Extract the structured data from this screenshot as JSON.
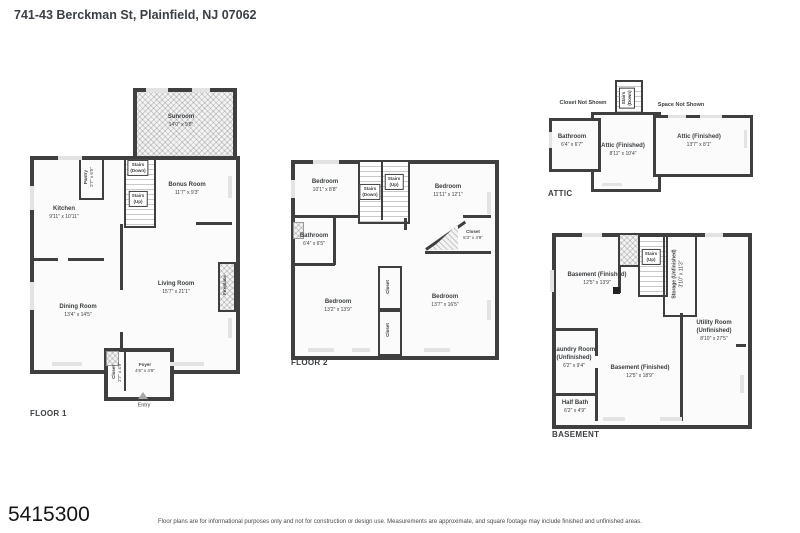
{
  "header": {
    "title": "741-43 Berckman St, Plainfield, NJ 07062"
  },
  "floor1": {
    "label": "FLOOR 1",
    "sunroom": {
      "name": "Sunroom",
      "dims": "14'0\" x 9'8\""
    },
    "pantry": {
      "name": "Pantry",
      "dims": "2'7\" x 6'5\""
    },
    "stairs_down": "Stairs\n(Down)",
    "stairs_up": "Stairs\n(Up)",
    "bonus": {
      "name": "Bonus Room",
      "dims": "11'7\" x 9'3\""
    },
    "kitchen": {
      "name": "Kitchen",
      "dims": "9'11\" x 10'11\""
    },
    "dining": {
      "name": "Dining Room",
      "dims": "13'4\" x 14'5\""
    },
    "living": {
      "name": "Living Room",
      "dims": "15'7\" x 21'1\""
    },
    "fireplace": {
      "name": "Fireplace"
    },
    "closet": {
      "name": "Closet",
      "dims": "2'7\" x 4'9\""
    },
    "foyer": {
      "name": "Foyer",
      "dims": "4'6\" x 4'9\""
    },
    "entry": {
      "name": "Entry"
    }
  },
  "floor2": {
    "label": "FLOOR 2",
    "bed1": {
      "name": "Bedroom",
      "dims": "10'1\" x 8'8\""
    },
    "bed2": {
      "name": "Bedroom",
      "dims": "11'11\" x 12'1\""
    },
    "bed3": {
      "name": "Bedroom",
      "dims": "13'2\" x 13'9\""
    },
    "bed4": {
      "name": "Bedroom",
      "dims": "13'7\" x 16'5\""
    },
    "stairs_down": "Stairs\n(Down)",
    "stairs_up": "Stairs\n(Up)",
    "bathroom": {
      "name": "Bathroom",
      "dims": "6'4\" x 6'5\""
    },
    "closet_right": {
      "name": "Closet",
      "dims": "5'3\" x 4'9\""
    },
    "closet_a": {
      "name": "Closet"
    },
    "closet_b": {
      "name": "Closet"
    }
  },
  "attic": {
    "label": "ATTIC",
    "closet_note": "Closet Not Shown",
    "space_note": "Space Not Shown",
    "stairs_down": "Stairs\n(Down)",
    "bathroom": {
      "name": "Bathroom",
      "dims": "6'4\" x 6'7\""
    },
    "attic1": {
      "name": "Attic (Finished)",
      "dims": "8'11\" x 10'4\""
    },
    "attic2": {
      "name": "Attic (Finished)",
      "dims": "13'7\" x 8'1\""
    }
  },
  "basement": {
    "label": "BASEMENT",
    "bsmt1": {
      "name": "Basement (Finished)",
      "dims": "12'5\" x 13'9\""
    },
    "stairs_up": "Stairs\n(Up)",
    "storage": {
      "name": "Storage (Unfinished)",
      "dims": "3'10\" x 11'3\""
    },
    "utility": {
      "name": "Utility Room",
      "name2": "(Unfinished)",
      "dims": "8'10\" x 27'5\""
    },
    "laundry": {
      "name": "Laundry Room",
      "name2": "(Unfinished)",
      "dims": "6'2\" x 9'4\""
    },
    "bsmt2": {
      "name": "Basement (Finished)",
      "dims": "12'5\" x 18'9\""
    },
    "halfbath": {
      "name": "Half Bath",
      "dims": "6'2\" x 4'9\""
    }
  },
  "footer": {
    "mls": "5415300",
    "disclaimer": "Floor plans are for informational purposes only and not for construction or design use. Measurements are approximate, and square footage may include finished and unfinished areas."
  },
  "colors": {
    "wall": "#3f3f3f",
    "text": "#3c4043",
    "room_fill": "#fafafa",
    "hatch_fill": "#f3f3f3"
  }
}
